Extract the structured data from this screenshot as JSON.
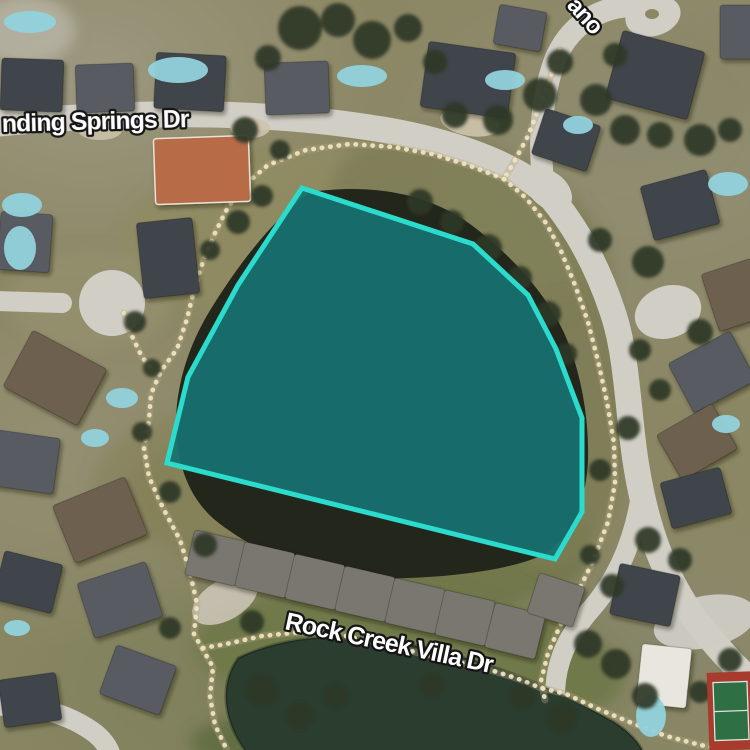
{
  "map": {
    "description": "satellite-view",
    "canvas": {
      "width": 750,
      "height": 750
    },
    "palette": {
      "road": "#d1cec6",
      "road_light": "#d8d5cd",
      "lake_water": "#23271b",
      "pond_water": "#2b3d2e",
      "trail_dot": "#eee3c2",
      "trail_base": "#b4a77f",
      "parcel_fill": "#177170",
      "parcel_stroke": "#2bdccd",
      "label_fill": "#ffffff",
      "label_outline": "#151515",
      "tree": "#2e3927",
      "pool": "#92d2dc",
      "court_red": "#a63b2e",
      "court_green": "#2e6f44",
      "roof": {
        "d": "#3f444b",
        "g": "#585c62",
        "b": "#6e6150",
        "v": "#7a776f",
        "t": "#b76c47",
        "w": "#e9e6df"
      }
    },
    "labels": [
      {
        "id": "street-label-winding-springs-dr",
        "text": "nding Springs Dr",
        "x": 2,
        "y": 132,
        "rotation": -1.5,
        "size": 25
      },
      {
        "id": "street-label-ano",
        "text": "ano",
        "x": 566,
        "y": 6,
        "rotation": 48,
        "size": 24
      },
      {
        "id": "street-label-rock-creek-villa-dr",
        "text": "Rock Creek Villa Dr",
        "x": 284,
        "y": 629,
        "rotation": 12,
        "size": 25
      }
    ],
    "parcel": {
      "name": "highlighted-lake-parcel",
      "points": [
        [
          302,
          188
        ],
        [
          473,
          244
        ],
        [
          528,
          295
        ],
        [
          556,
          349
        ],
        [
          582,
          418
        ],
        [
          582,
          512
        ],
        [
          555,
          559
        ],
        [
          167,
          463
        ],
        [
          188,
          377
        ],
        [
          238,
          285
        ]
      ],
      "fill_opacity": 0.93,
      "stroke_width": 5
    },
    "ground": [
      [
        250,
        225,
        130,
        75,
        -15,
        "#8f8b63",
        0.9
      ],
      [
        470,
        240,
        150,
        95,
        25,
        "#7e7e57",
        0.9
      ],
      [
        360,
        520,
        235,
        85,
        8,
        "#6f7649",
        0.85
      ],
      [
        560,
        430,
        70,
        140,
        5,
        "#7d7c55",
        0.8
      ],
      [
        200,
        480,
        110,
        70,
        -10,
        "#8a845e",
        0.8
      ],
      [
        410,
        660,
        215,
        70,
        5,
        "#6e7848",
        0.9
      ],
      [
        640,
        120,
        95,
        65,
        0,
        "#8e8a70",
        0.55
      ],
      [
        90,
        300,
        80,
        50,
        0,
        "#96926f",
        0.6
      ],
      [
        400,
        742,
        210,
        40,
        0,
        "#5c693e",
        0.8
      ],
      [
        690,
        80,
        70,
        50,
        0,
        "#8a8666",
        0.5
      ],
      [
        25,
        30,
        50,
        35,
        0,
        "#b9b5a8",
        0.8
      ]
    ],
    "roads": [
      {
        "d": "M -6 124 C 120 112 255 108 385 130 C 455 142 515 165 545 192",
        "w": 26
      },
      {
        "d": "M 545 195 C 538 150 540 100 555 60 C 565 35 585 15 615 8 C 635 4 650 8 656 16",
        "w": 22
      },
      {
        "d": "M 543 188 C 572 220 596 262 612 310 C 628 355 628 420 637 470 C 647 530 664 575 694 618 C 714 644 734 666 756 686",
        "w": 26
      },
      {
        "d": "M -6 301 L 62 303",
        "w": 20
      },
      {
        "d": "M -6 706 C 40 704 72 716 96 734 C 104 741 109 748 111 756",
        "w": 20
      },
      {
        "d": "M 641 495 C 634 540 618 578 592 608 C 573 630 560 650 556 680 C 553 705 556 730 562 755",
        "w": 20
      }
    ],
    "pads": [
      [
        549,
        190,
        26,
        18,
        40,
        "#d1cec6",
        1
      ],
      [
        653,
        16,
        28,
        20,
        -15,
        "#d1cec6",
        1
      ],
      [
        668,
        312,
        34,
        26,
        -20,
        "#d1cec6",
        1
      ],
      [
        112,
        303,
        33,
        33,
        0,
        "#d1cec6",
        1
      ],
      [
        705,
        622,
        52,
        26,
        -12,
        "#cfccc4",
        0.95
      ],
      [
        225,
        600,
        36,
        20,
        -30,
        "#cfc9bb",
        0.85
      ],
      [
        470,
        122,
        30,
        14,
        10,
        "#cec3ac",
        0.9
      ],
      [
        250,
        128,
        20,
        10,
        0,
        "#cec3ac",
        0.9
      ],
      [
        100,
        130,
        22,
        10,
        0,
        "#cec3ac",
        0.85
      ],
      [
        652,
        14,
        7,
        5,
        0,
        "#8b8764",
        1
      ]
    ],
    "lake": {
      "name": "central-lake",
      "d": "M 310 192 C 360 185 420 188 470 224 C 505 250 545 290 565 335 C 582 375 589 420 588 460 C 586 505 570 542 540 556 C 505 572 430 580 370 578 C 310 576 255 552 215 520 C 188 497 176 462 176 420 C 177 378 192 338 214 304 C 238 266 270 222 310 192 Z"
    },
    "pond": {
      "name": "south-pond",
      "d": "M 238 658 C 288 634 352 630 426 648 C 505 666 562 692 614 722 C 630 732 640 744 643 752 L 246 752 C 224 722 218 686 238 658 Z"
    },
    "trails": [
      [
        [
          560,
          50
        ],
        [
          551,
          76
        ],
        [
          540,
          105
        ],
        [
          528,
          136
        ],
        [
          514,
          162
        ],
        [
          504,
          179
        ]
      ],
      [
        [
          504,
          179
        ],
        [
          468,
          165
        ],
        [
          432,
          154
        ],
        [
          393,
          147
        ],
        [
          350,
          144
        ],
        [
          306,
          150
        ],
        [
          268,
          165
        ],
        [
          246,
          184
        ],
        [
          228,
          207
        ],
        [
          215,
          233
        ],
        [
          203,
          261
        ],
        [
          194,
          290
        ],
        [
          187,
          319
        ],
        [
          177,
          349
        ],
        [
          161,
          371
        ],
        [
          151,
          394
        ],
        [
          149,
          420
        ],
        [
          144,
          448
        ],
        [
          149,
          477
        ],
        [
          163,
          508
        ],
        [
          180,
          540
        ],
        [
          190,
          572
        ],
        [
          197,
          604
        ],
        [
          194,
          634
        ],
        [
          203,
          650
        ],
        [
          213,
          667
        ],
        [
          210,
          696
        ],
        [
          215,
          725
        ],
        [
          227,
          750
        ]
      ],
      [
        [
          124,
          313
        ],
        [
          132,
          336
        ],
        [
          142,
          357
        ],
        [
          154,
          372
        ]
      ],
      [
        [
          504,
          179
        ],
        [
          526,
          198
        ],
        [
          546,
          223
        ],
        [
          561,
          251
        ],
        [
          575,
          285
        ],
        [
          588,
          322
        ],
        [
          598,
          361
        ],
        [
          607,
          402
        ],
        [
          614,
          443
        ],
        [
          615,
          483
        ],
        [
          608,
          522
        ],
        [
          593,
          561
        ],
        [
          576,
          596
        ],
        [
          560,
          626
        ],
        [
          548,
          653
        ],
        [
          541,
          681
        ],
        [
          545,
          700
        ]
      ],
      [
        [
          203,
          648
        ],
        [
          226,
          644
        ],
        [
          262,
          636
        ],
        [
          302,
          632
        ],
        [
          346,
          636
        ],
        [
          390,
          646
        ],
        [
          436,
          657
        ],
        [
          481,
          667
        ],
        [
          516,
          678
        ],
        [
          541,
          688
        ],
        [
          566,
          694
        ],
        [
          598,
          709
        ],
        [
          632,
          723
        ],
        [
          666,
          736
        ],
        [
          700,
          745
        ],
        [
          730,
          750
        ]
      ]
    ],
    "houses": [
      [
        32,
        85,
        62,
        52,
        2,
        "d"
      ],
      [
        105,
        88,
        58,
        48,
        -2,
        "g"
      ],
      [
        190,
        82,
        70,
        56,
        3,
        "d"
      ],
      [
        297,
        88,
        64,
        52,
        -2,
        "g"
      ],
      [
        468,
        80,
        88,
        66,
        8,
        "d"
      ],
      [
        520,
        28,
        48,
        40,
        10,
        "g"
      ],
      [
        655,
        75,
        85,
        70,
        15,
        "d"
      ],
      [
        742,
        32,
        44,
        54,
        0,
        "g"
      ],
      [
        566,
        140,
        58,
        48,
        18,
        "d"
      ],
      [
        202,
        170,
        95,
        66,
        -2,
        "t"
      ],
      [
        680,
        205,
        68,
        56,
        -15,
        "d"
      ],
      [
        735,
        295,
        52,
        60,
        -18,
        "b"
      ],
      [
        712,
        372,
        70,
        56,
        -28,
        "g"
      ],
      [
        697,
        442,
        64,
        52,
        -30,
        "b"
      ],
      [
        696,
        498,
        62,
        48,
        -15,
        "d"
      ],
      [
        645,
        595,
        62,
        52,
        12,
        "d"
      ],
      [
        168,
        258,
        56,
        76,
        -6,
        "d"
      ],
      [
        25,
        242,
        52,
        58,
        4,
        "g"
      ],
      [
        55,
        378,
        84,
        64,
        28,
        "b"
      ],
      [
        25,
        462,
        64,
        56,
        8,
        "g"
      ],
      [
        100,
        520,
        78,
        62,
        -22,
        "b"
      ],
      [
        28,
        582,
        60,
        50,
        14,
        "d"
      ],
      [
        120,
        600,
        72,
        58,
        -18,
        "g"
      ],
      [
        138,
        680,
        64,
        52,
        20,
        "g"
      ],
      [
        30,
        700,
        58,
        48,
        -8,
        "d"
      ],
      [
        215,
        558,
        52,
        46,
        13,
        "v"
      ],
      [
        265,
        570,
        52,
        46,
        13,
        "v"
      ],
      [
        315,
        582,
        52,
        46,
        13,
        "v"
      ],
      [
        365,
        594,
        52,
        46,
        13,
        "v"
      ],
      [
        415,
        606,
        52,
        46,
        13,
        "v"
      ],
      [
        465,
        618,
        52,
        46,
        13,
        "v"
      ],
      [
        515,
        631,
        52,
        46,
        14,
        "v"
      ],
      [
        556,
        600,
        48,
        42,
        18,
        "v"
      ],
      [
        664,
        676,
        50,
        60,
        6,
        "w"
      ]
    ],
    "pools": [
      [
        178,
        70,
        30,
        13
      ],
      [
        362,
        76,
        25,
        11
      ],
      [
        505,
        80,
        20,
        10
      ],
      [
        30,
        22,
        26,
        11
      ],
      [
        22,
        205,
        20,
        12
      ],
      [
        20,
        248,
        16,
        22
      ],
      [
        122,
        398,
        16,
        10
      ],
      [
        95,
        438,
        14,
        9
      ],
      [
        578,
        125,
        15,
        9
      ],
      [
        728,
        184,
        20,
        12
      ],
      [
        726,
        424,
        14,
        9
      ],
      [
        17,
        628,
        13,
        8
      ],
      [
        651,
        716,
        15,
        21
      ]
    ],
    "trees": [
      [
        300,
        28,
        22
      ],
      [
        338,
        20,
        17
      ],
      [
        372,
        40,
        19
      ],
      [
        268,
        58,
        13
      ],
      [
        408,
        28,
        14
      ],
      [
        435,
        62,
        12
      ],
      [
        455,
        115,
        13
      ],
      [
        498,
        120,
        15
      ],
      [
        540,
        95,
        17
      ],
      [
        560,
        62,
        13
      ],
      [
        596,
        100,
        16
      ],
      [
        625,
        130,
        15
      ],
      [
        660,
        135,
        13
      ],
      [
        700,
        140,
        16
      ],
      [
        730,
        130,
        12
      ],
      [
        615,
        55,
        12
      ],
      [
        262,
        196,
        11
      ],
      [
        238,
        222,
        12
      ],
      [
        210,
        250,
        10
      ],
      [
        420,
        202,
        13
      ],
      [
        452,
        222,
        12
      ],
      [
        488,
        248,
        14
      ],
      [
        520,
        278,
        12
      ],
      [
        548,
        314,
        13
      ],
      [
        566,
        354,
        11
      ],
      [
        600,
        240,
        12
      ],
      [
        648,
        262,
        16
      ],
      [
        700,
        332,
        13
      ],
      [
        640,
        350,
        11
      ],
      [
        628,
        428,
        12
      ],
      [
        600,
        470,
        11
      ],
      [
        648,
        540,
        13
      ],
      [
        612,
        586,
        12
      ],
      [
        588,
        644,
        14
      ],
      [
        616,
        664,
        15
      ],
      [
        645,
        696,
        13
      ],
      [
        700,
        692,
        11
      ],
      [
        730,
        660,
        12
      ],
      [
        262,
        690,
        15
      ],
      [
        300,
        716,
        13
      ],
      [
        336,
        696,
        12
      ],
      [
        432,
        686,
        11
      ],
      [
        522,
        696,
        12
      ],
      [
        562,
        718,
        14
      ],
      [
        205,
        545,
        12
      ],
      [
        252,
        622,
        12
      ],
      [
        170,
        628,
        11
      ],
      [
        135,
        322,
        11
      ],
      [
        152,
        368,
        9
      ],
      [
        142,
        432,
        10
      ],
      [
        170,
        492,
        11
      ],
      [
        245,
        130,
        13
      ],
      [
        280,
        150,
        10
      ],
      [
        660,
        390,
        11
      ],
      [
        680,
        560,
        12
      ],
      [
        590,
        555,
        10
      ]
    ],
    "court": {
      "name": "tennis-court",
      "cx": 731,
      "cy": 711,
      "rotation": -2,
      "outer": [
        708,
        672,
        46,
        78
      ],
      "inner": [
        714,
        682,
        34,
        58
      ],
      "line_y": 711
    }
  }
}
